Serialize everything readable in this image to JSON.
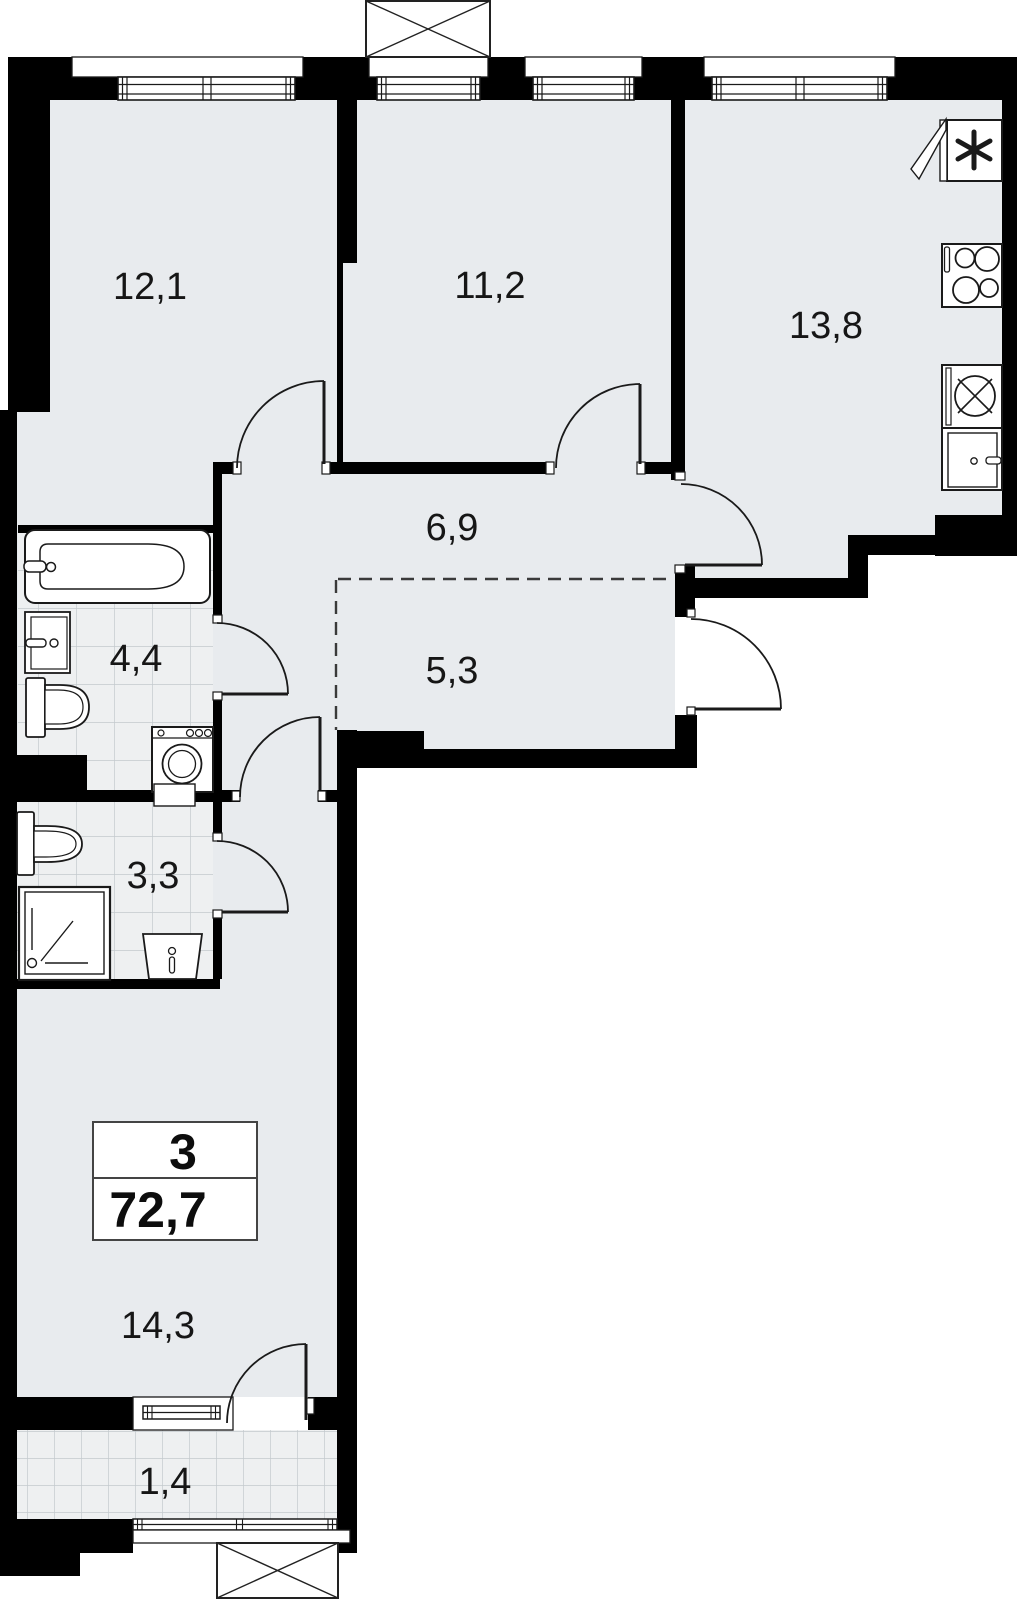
{
  "title": "apartment-floor-plan",
  "colors": {
    "wall": "#000000",
    "floor": "#e8ebee",
    "tile_floor": "#eef0f1",
    "tile_grid": "#c3c9cd",
    "outline": "#1a1a1a",
    "background": "#ffffff"
  },
  "rooms": {
    "bedroom1": {
      "area": "12,1"
    },
    "bedroom2": {
      "area": "11,2"
    },
    "kitchen": {
      "area": "13,8"
    },
    "hallway": {
      "area": "6,9"
    },
    "wardrobe": {
      "area": "5,3"
    },
    "bathroom": {
      "area": "4,4"
    },
    "shower_room": {
      "area": "3,3"
    },
    "living_room": {
      "area": "14,3"
    },
    "balcony": {
      "area": "1,4"
    }
  },
  "info_box": {
    "room_count": "3",
    "total_area": "72,7"
  },
  "icons": {
    "bathtub-icon": "bathtub with faucet",
    "washbasin-icon": "wash basin with tap",
    "toilet-icon": "toilet with tank",
    "washing-machine-icon": "washing machine with drum",
    "shower-icon": "shower tray with drain",
    "fridge-icon": "refrigerator with open door and snowflake",
    "stove-icon": "4-burner cooktop",
    "kitchen-sink-icon": "kitchen sink crossed circle",
    "kitchen-cabinet-icon": "under-counter cabinet",
    "vent-shaft-icon": "crossed box shaft",
    "door-arc-icon": "door swing arc",
    "window-icon": "double-line window"
  }
}
